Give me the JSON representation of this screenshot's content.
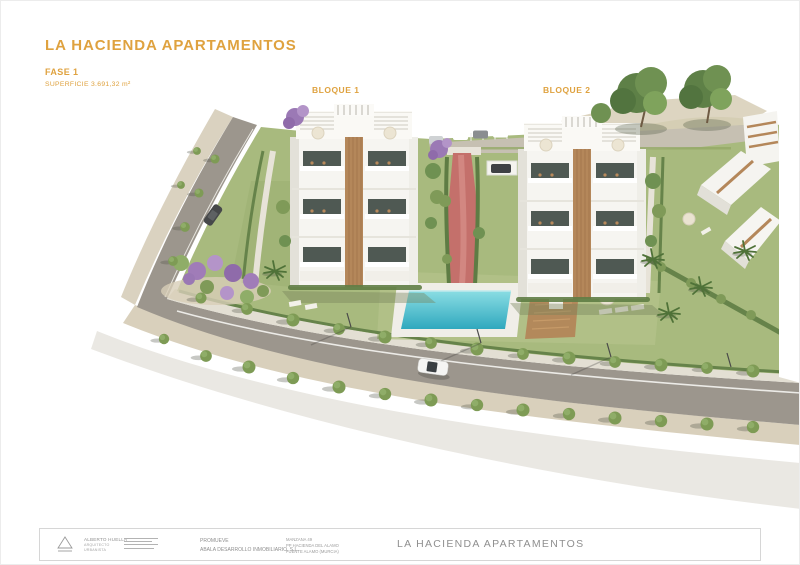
{
  "header": {
    "title": "LA HACIENDA APARTAMENTOS",
    "phase": "FASE 1",
    "surface": "SUPERFICIE 3.691,32 m²"
  },
  "plan": {
    "bloque1_label": "BLOQUE 1",
    "bloque2_label": "BLOQUE 2"
  },
  "colors": {
    "accent": "#DFA23F",
    "footer_text": "#8F8F8F",
    "lawn": "#A8BA7E",
    "road": "#9C968D",
    "sidewalk_sand": "#DAD2C0",
    "pool_light": "#8ADDE3",
    "pool_dark": "#2FA8BE",
    "path_red": "#C4706B",
    "wood_deck": "#B3895B",
    "tree_green": "#6F9152",
    "shrub_purple": "#A07CB8",
    "building_white": "#F6F5F1"
  },
  "footer": {
    "architect": {
      "name": "ALBERTO HUELLA",
      "role1": "ARQUITECTO",
      "role2": "URBANISTA"
    },
    "promoter": {
      "label": "PROMUEVE",
      "name": "ABALA DESARROLLO INMOBILIARIO, S.L."
    },
    "site": {
      "line1": "MANZANA 49",
      "line2": "PP HACIENDA DEL ALAMO",
      "line3": "FUENTE ALAMO (MURCIA)"
    },
    "project_title": "LA HACIENDA APARTAMENTOS"
  }
}
